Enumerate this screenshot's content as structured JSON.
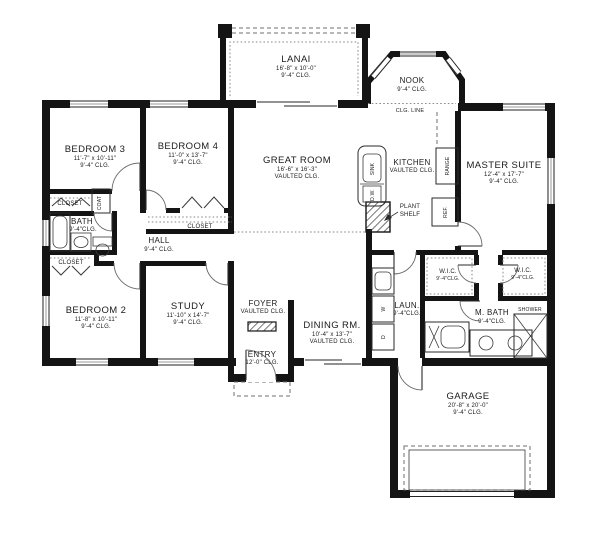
{
  "page": {
    "background": "#ffffff",
    "wall_color": "#141414",
    "line_color": "#6a6a6a"
  },
  "rooms": {
    "lanai": {
      "name": "LANAI",
      "dims": "16'-8\" x 10'-0\"",
      "ceiling": "9'-4\" CLG."
    },
    "nook": {
      "name": "NOOK",
      "ceiling": "9'-4\" CLG."
    },
    "great_room": {
      "name": "GREAT ROOM",
      "dims": "16'-6\" x 16'-3\"",
      "ceiling": "VAULTED CLG."
    },
    "kitchen": {
      "name": "KITCHEN",
      "ceiling": "VAULTED CLG."
    },
    "master_suite": {
      "name": "MASTER SUITE",
      "dims": "12'-4\" x 17'-7\"",
      "ceiling": "9'-4\" CLG."
    },
    "bedroom3": {
      "name": "BEDROOM 3",
      "dims": "11'-7\" x 10'-11\"",
      "ceiling": "9'-4\" CLG."
    },
    "bedroom4": {
      "name": "BEDROOM 4",
      "dims": "11'-0\" x 13'-7\"",
      "ceiling": "9'-4\" CLG."
    },
    "bedroom2": {
      "name": "BEDROOM 2",
      "dims": "11'-8\" x 10'-11\"",
      "ceiling": "9'-4\" CLG."
    },
    "study": {
      "name": "STUDY",
      "dims": "11'-10\" x 14'-7\"",
      "ceiling": "9'-4\" CLG."
    },
    "bath": {
      "name": "BATH",
      "ceiling": "9'-4\"CLG."
    },
    "hall": {
      "name": "HALL",
      "ceiling": "9'-4\" CLG."
    },
    "foyer": {
      "name": "FOYER",
      "ceiling": "VAULTED CLG."
    },
    "dining": {
      "name": "DINING RM.",
      "dims": "10'-4\" x 13'-7\"",
      "ceiling": "VAULTED CLG."
    },
    "entry": {
      "name": "ENTRY",
      "ceiling": "12'-0\" CLG."
    },
    "laundry": {
      "name": "LAUN.",
      "ceiling": "9'-4\"CLG."
    },
    "wic1": {
      "name": "W.I.C.",
      "ceiling": "9'-4\"CLG."
    },
    "wic2": {
      "name": "W.I.C.",
      "ceiling": "9'-4\"CLG."
    },
    "master_bath": {
      "name": "M. BATH",
      "ceiling": "9'-4\"CLG."
    },
    "garage": {
      "name": "GARAGE",
      "dims": "20'-8\" x 20'-0\"",
      "ceiling": "9'-4\" CLG."
    }
  },
  "labels": {
    "closet": "CLOSET",
    "coat": "COAT",
    "clg_line": "CLG. LINE",
    "plant_shelf_line1": "PLANT",
    "plant_shelf_line2": "SHELF",
    "shower": "SHOWER",
    "sink": "SINK",
    "dishwasher": "D.W.",
    "range": "RANGE",
    "refrigerator": "REF.",
    "washer": "W",
    "dryer": "D"
  }
}
